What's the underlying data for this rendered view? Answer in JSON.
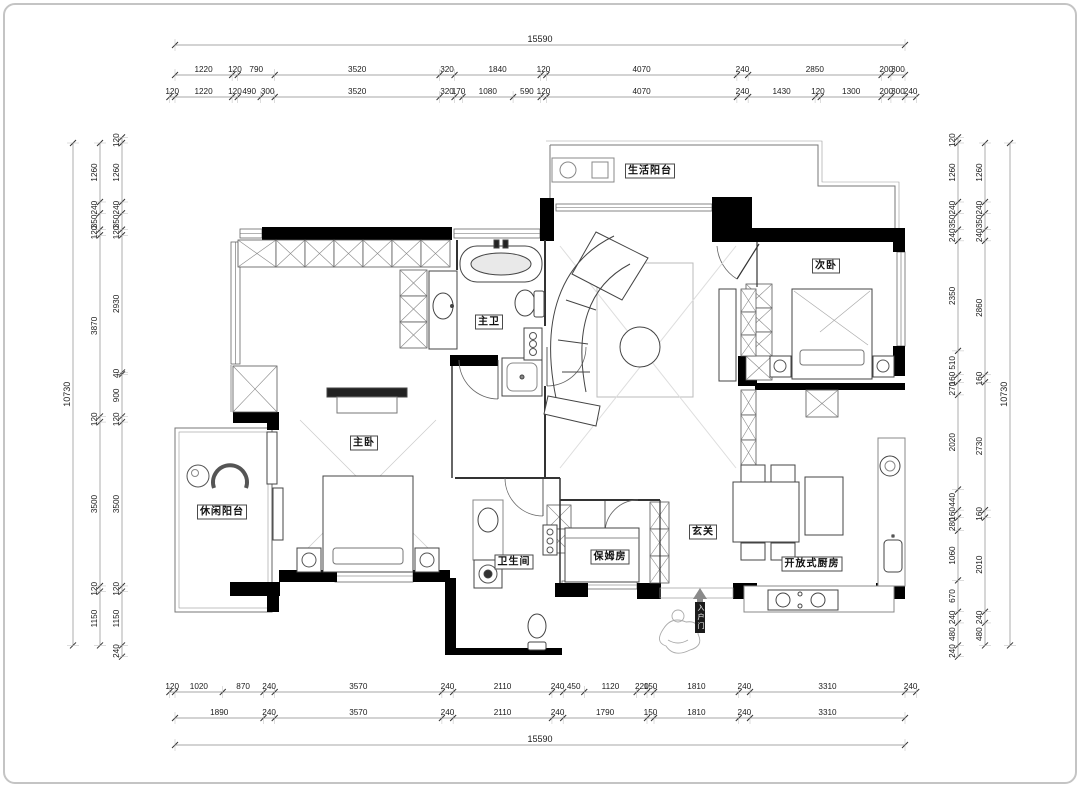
{
  "drawing": {
    "type": "residential floor plan",
    "units": "mm",
    "overall_width": "15590",
    "overall_height": "10730"
  },
  "dimensions": {
    "top_outer": [
      "15590"
    ],
    "top_row1": [
      "1220",
      "120",
      "790",
      "3520",
      "320",
      "1840",
      "120",
      "4070",
      "240",
      "2850",
      "200",
      "300"
    ],
    "top_row2": [
      "120",
      "1220",
      "120",
      "490",
      "300",
      "3520",
      "320",
      "170",
      "1080",
      "590",
      "120",
      "4070",
      "240",
      "1430",
      "120",
      "1300",
      "200",
      "300",
      "240"
    ],
    "bottom_row1": [
      "120",
      "1020",
      "870",
      "240",
      "3570",
      "240",
      "2110",
      "240",
      "450",
      "1120",
      "220",
      "150",
      "1810",
      "240",
      "3310",
      "240"
    ],
    "bottom_row2": [
      "1890",
      "240",
      "3570",
      "240",
      "2110",
      "240",
      "1790",
      "150",
      "1810",
      "240",
      "3310"
    ],
    "bottom_outer": [
      "15590"
    ],
    "left_outer": [
      "10730"
    ],
    "left_mid": [
      "1260",
      "240",
      "350",
      "120",
      "3870",
      "120",
      "3500",
      "120",
      "1150"
    ],
    "left_inner": [
      "120",
      "1260",
      "240",
      "350",
      "120",
      "2930",
      "40",
      "900",
      "120",
      "3500",
      "120",
      "1150",
      "240"
    ],
    "right_inner": [
      "120",
      "1260",
      "240",
      "350",
      "240",
      "2350",
      "510",
      "160",
      "270",
      "2020",
      "440",
      "160",
      "280",
      "1060",
      "670",
      "240",
      "480",
      "240"
    ],
    "right_mid": [
      "1260",
      "240",
      "350",
      "240",
      "2860",
      "160",
      "2730",
      "160",
      "2010",
      "240",
      "480"
    ],
    "right_outer": [
      "10730"
    ]
  },
  "rooms": [
    {
      "id": "laundry-balcony",
      "label": "生活阳台"
    },
    {
      "id": "bedroom-2",
      "label": "次卧"
    },
    {
      "id": "master-bath",
      "label": "主卫"
    },
    {
      "id": "master-bedroom",
      "label": "主卧"
    },
    {
      "id": "leisure-balcony",
      "label": "休闲阳台"
    },
    {
      "id": "bathroom",
      "label": "卫生间"
    },
    {
      "id": "nanny-room",
      "label": "保姆房"
    },
    {
      "id": "foyer",
      "label": "玄关"
    },
    {
      "id": "open-kitchen",
      "label": "开放式厨房"
    }
  ],
  "entry": {
    "label": "入户门",
    "arrow": "⇧"
  },
  "colors": {
    "wall": "#000000",
    "line": "#4a4a4a",
    "light_line": "#999999",
    "dim_line": "#8a8a8a",
    "dim_text": "#1c1c1c",
    "label_text": "#111111",
    "bg": "#ffffff",
    "frame": "#c4c4c4"
  }
}
